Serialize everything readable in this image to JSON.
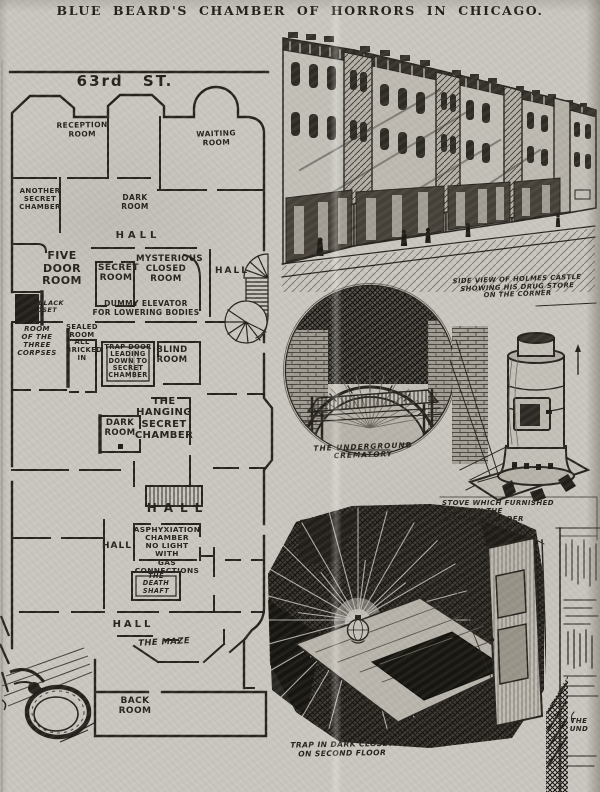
{
  "page": {
    "title": "BLUE BEARD'S CHAMBER OF HORRORS IN CHICAGO."
  },
  "colors": {
    "paper": "#c9c6bf",
    "ink": "#26231e"
  },
  "floorplan": {
    "labels": [
      {
        "id": "street",
        "text": "63rd  ST."
      },
      {
        "id": "reception-room",
        "text": "RECEPTION\nROOM"
      },
      {
        "id": "waiting-room",
        "text": "WAITING\nROOM"
      },
      {
        "id": "another-secret-chamber",
        "text": "ANOTHER\nSECRET\nCHAMBER"
      },
      {
        "id": "dark-room-upper",
        "text": "DARK\nROOM"
      },
      {
        "id": "hall-upper",
        "text": "HALL"
      },
      {
        "id": "five-door-room",
        "text": "FIVE\nDOOR\nROOM"
      },
      {
        "id": "secret-room",
        "text": "SECRET\nROOM"
      },
      {
        "id": "mysterious-closed-room",
        "text": "MYSTERIOUS\nCLOSED\nROOM"
      },
      {
        "id": "hall-right",
        "text": "HALL"
      },
      {
        "id": "black-closet",
        "text": "THE BLACK\nCLOSET"
      },
      {
        "id": "dummy-elevator",
        "text": "DUMMY ELEVATOR\nFOR LOWERING BODIES"
      },
      {
        "id": "room-of-three-corpses",
        "text": "ROOM\nOF THE\nTHREE\nCORPSES"
      },
      {
        "id": "sealed-room",
        "text": "SEALED\nROOM\nALL\nBRICKED\nIN"
      },
      {
        "id": "trap-door",
        "text": "TRAP DOOR\nLEADING\nDOWN TO\nSECRET\nCHAMBER"
      },
      {
        "id": "blind-room",
        "text": "BLIND\nROOM"
      },
      {
        "id": "hanging-secret-chamber",
        "text": "THE\nHANGING\nSECRET\nCHAMBER"
      },
      {
        "id": "dark-room-lower",
        "text": "DARK\nROOM"
      },
      {
        "id": "hall-center",
        "text": "HALL"
      },
      {
        "id": "asphyxiation-chamber",
        "text": "ASPHYXIATION\nCHAMBER\nNO LIGHT\nWITH\nGAS\nCONNECTIONS"
      },
      {
        "id": "hall-left",
        "text": "HALL"
      },
      {
        "id": "death-shaft",
        "text": "THE\nDEATH\nSHAFT"
      },
      {
        "id": "hall-bottom",
        "text": "HALL"
      },
      {
        "id": "the-maze",
        "text": "THE MAZE"
      },
      {
        "id": "back-room",
        "text": "BACK\nROOM"
      }
    ]
  },
  "captions": {
    "side_view": "SIDE VIEW OF HOLMES CASTLE\nSHOWING HIS DRUG STORE\nON THE CORNER",
    "crematory": "THE UNDERGROUND CREMATORY",
    "stove": "STOVE WHICH FURNISHED\nCLEWS IN THE\nWILLIAMS MURDER",
    "trap": "TRAP IN DARK CLOSET\nON SECOND FLOOR",
    "partial": "THE\nUND"
  }
}
